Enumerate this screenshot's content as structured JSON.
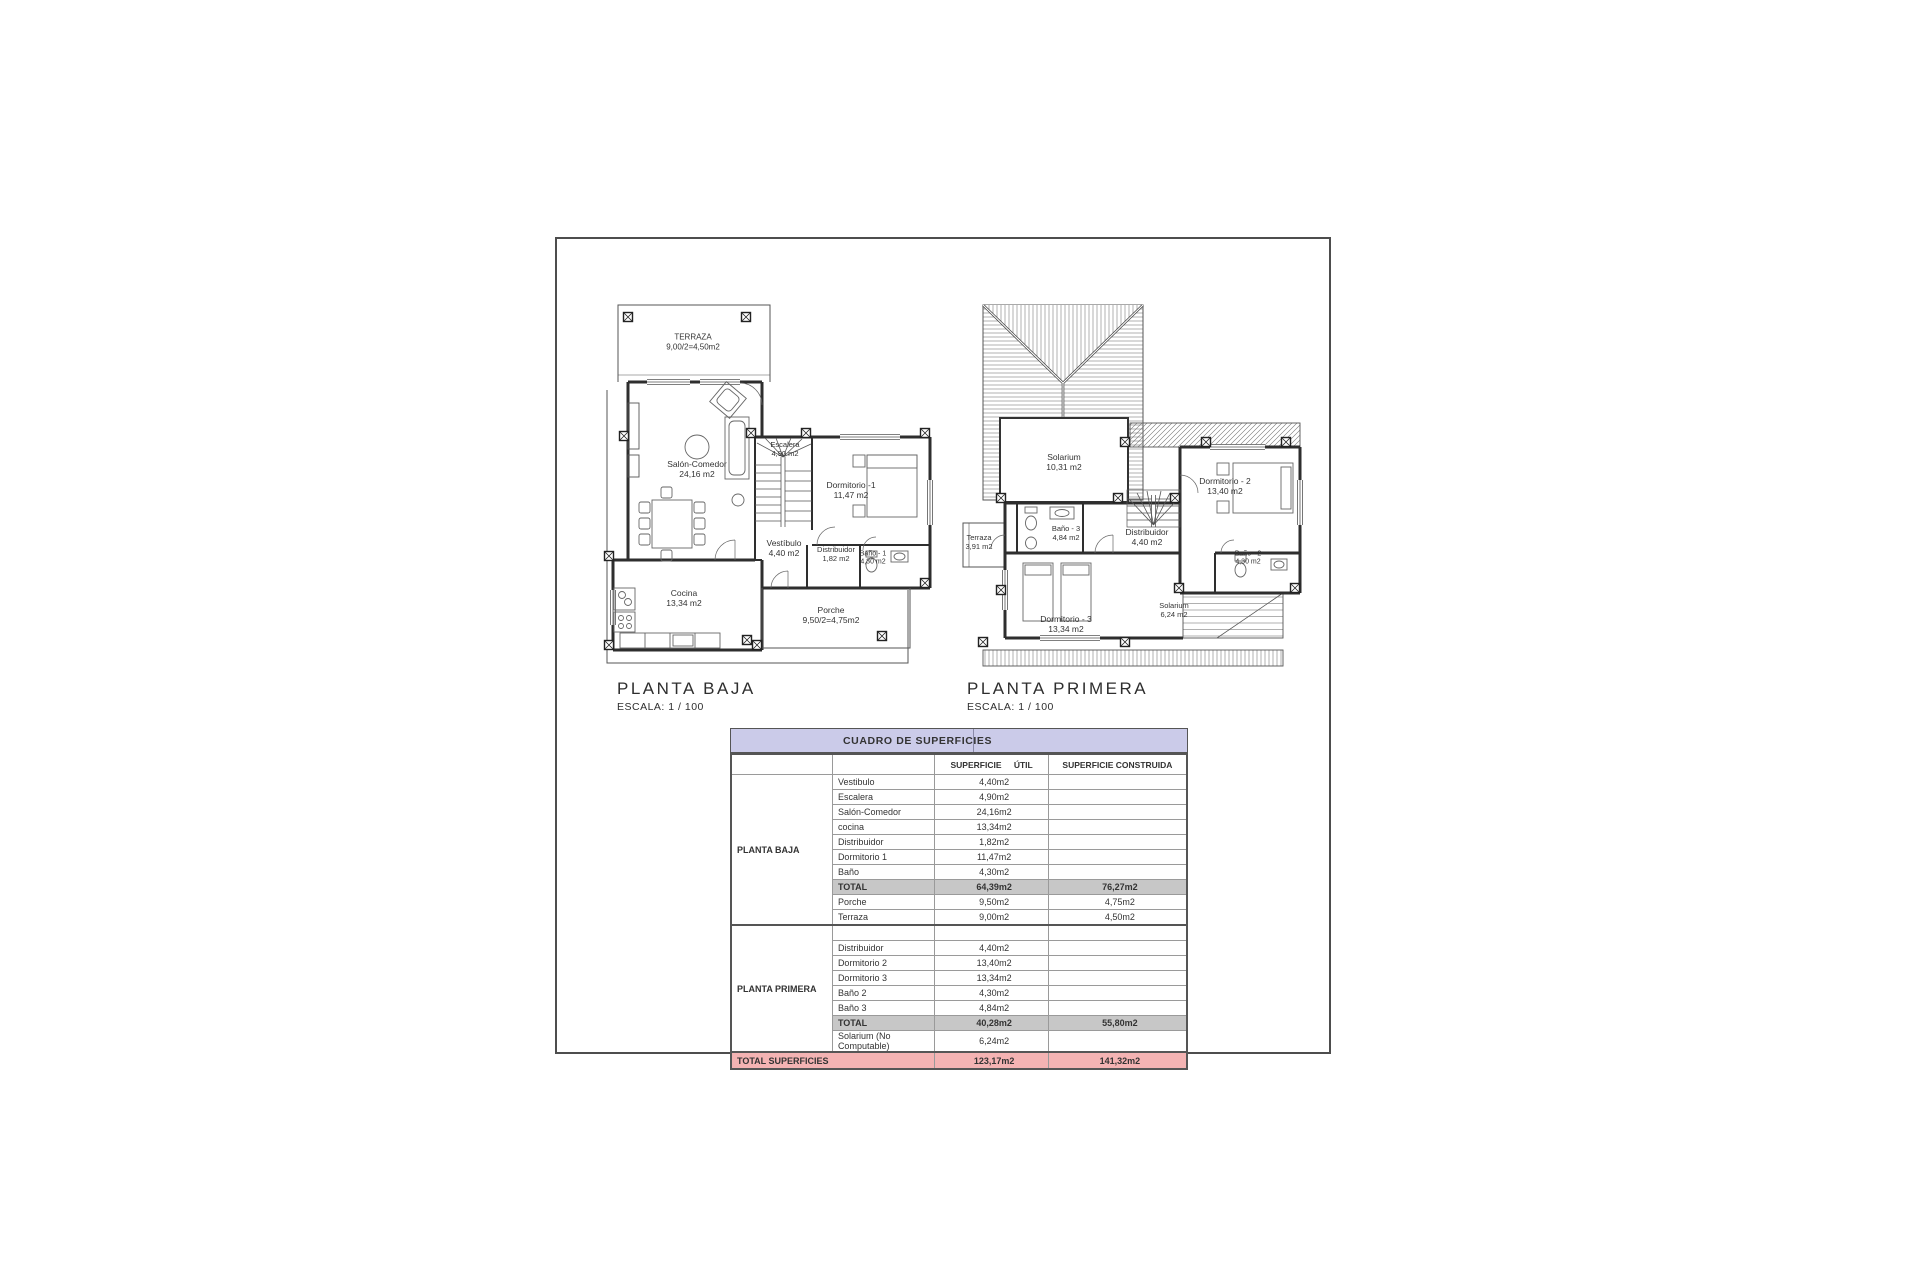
{
  "plans": {
    "baja": {
      "title": "PLANTA BAJA",
      "scale": "ESCALA: 1 / 100",
      "rooms": {
        "terraza": {
          "name": "TERRAZA",
          "area": "9,00/2=4,50m2"
        },
        "salon": {
          "name": "Salón-Comedor",
          "area": "24,16 m2"
        },
        "escalera": {
          "name": "Escalera",
          "area": "4,90 m2"
        },
        "dormitorio1": {
          "name": "Dormitorio -1",
          "area": "11,47 m2"
        },
        "vestibulo": {
          "name": "Vestíbulo",
          "area": "4,40 m2"
        },
        "distribuidor": {
          "name": "Distribuidor",
          "area": "1,82 m2"
        },
        "bano1": {
          "name": "Baño - 1",
          "area": "4,30 m2"
        },
        "cocina": {
          "name": "Cocina",
          "area": "13,34 m2"
        },
        "porche": {
          "name": "Porche",
          "area": "9,50/2=4,75m2"
        }
      }
    },
    "primera": {
      "title": "PLANTA PRIMERA",
      "scale": "ESCALA: 1 / 100",
      "rooms": {
        "solarium": {
          "name": "Solarium",
          "area": "10,31 m2"
        },
        "dormitorio2": {
          "name": "Dormitorio - 2",
          "area": "13,40 m2"
        },
        "terraza": {
          "name": "Terraza",
          "area": "3,91 m2"
        },
        "bano3": {
          "name": "Baño - 3",
          "area": "4,84 m2"
        },
        "distribuidor": {
          "name": "Distribuidor",
          "area": "4,40 m2"
        },
        "bano2": {
          "name": "Baño - 2",
          "area": "4,30 m2"
        },
        "dormitorio3": {
          "name": "Dormitorio - 3",
          "area": "13,34 m2"
        },
        "solarium2": {
          "name": "Solarium",
          "area": "6,24 m2"
        }
      }
    }
  },
  "table": {
    "title": "CUADRO DE SUPERFICIES",
    "columns": {
      "util": "SUPERFICIE ÚTIL",
      "construida": "SUPERFICIE CONSTRUIDA"
    },
    "groups": [
      {
        "label": "PLANTA BAJA",
        "rows": [
          {
            "type": "normal",
            "label": "Vestibulo",
            "util": "4,40m2",
            "construida": ""
          },
          {
            "type": "normal",
            "label": "Escalera",
            "util": "4,90m2",
            "construida": ""
          },
          {
            "type": "normal",
            "label": "Salón-Comedor",
            "util": "24,16m2",
            "construida": ""
          },
          {
            "type": "normal",
            "label": "cocina",
            "util": "13,34m2",
            "construida": ""
          },
          {
            "type": "normal",
            "label": "Distribuidor",
            "util": "1,82m2",
            "construida": ""
          },
          {
            "type": "normal",
            "label": "Dormitorio 1",
            "util": "11,47m2",
            "construida": ""
          },
          {
            "type": "normal",
            "label": "Baño",
            "util": "4,30m2",
            "construida": ""
          },
          {
            "type": "total",
            "label": "TOTAL",
            "util": "64,39m2",
            "construida": "76,27m2"
          },
          {
            "type": "normal",
            "label": "Porche",
            "util": "9,50m2",
            "construida": "4,75m2"
          },
          {
            "type": "normal",
            "label": "Terraza",
            "util": "9,00m2",
            "construida": "4,50m2"
          }
        ]
      },
      {
        "label": "PLANTA PRIMERA",
        "rows": [
          {
            "type": "empty",
            "label": "",
            "util": "",
            "construida": ""
          },
          {
            "type": "normal",
            "label": "Distribuidor",
            "util": "4,40m2",
            "construida": ""
          },
          {
            "type": "normal",
            "label": "Dormitorio 2",
            "util": "13,40m2",
            "construida": ""
          },
          {
            "type": "normal",
            "label": "Dormitorio 3",
            "util": "13,34m2",
            "construida": ""
          },
          {
            "type": "normal",
            "label": "Baño 2",
            "util": "4,30m2",
            "construida": ""
          },
          {
            "type": "normal",
            "label": "Baño 3",
            "util": "4,84m2",
            "construida": ""
          },
          {
            "type": "total",
            "label": "TOTAL",
            "util": "40,28m2",
            "construida": "55,80m2"
          },
          {
            "type": "normal",
            "label": "Solarium (No Computable)",
            "util": "6,24m2",
            "construida": ""
          }
        ]
      }
    ],
    "grand_total": {
      "label": "TOTAL SUPERFICIES",
      "util": "123,17m2",
      "construida": "141,32m2"
    }
  },
  "colors": {
    "header_purple": "#cbcbe9",
    "total_gray": "#c7c7c7",
    "grand_pink": "#f4b3b3",
    "line_dark": "#303030"
  }
}
